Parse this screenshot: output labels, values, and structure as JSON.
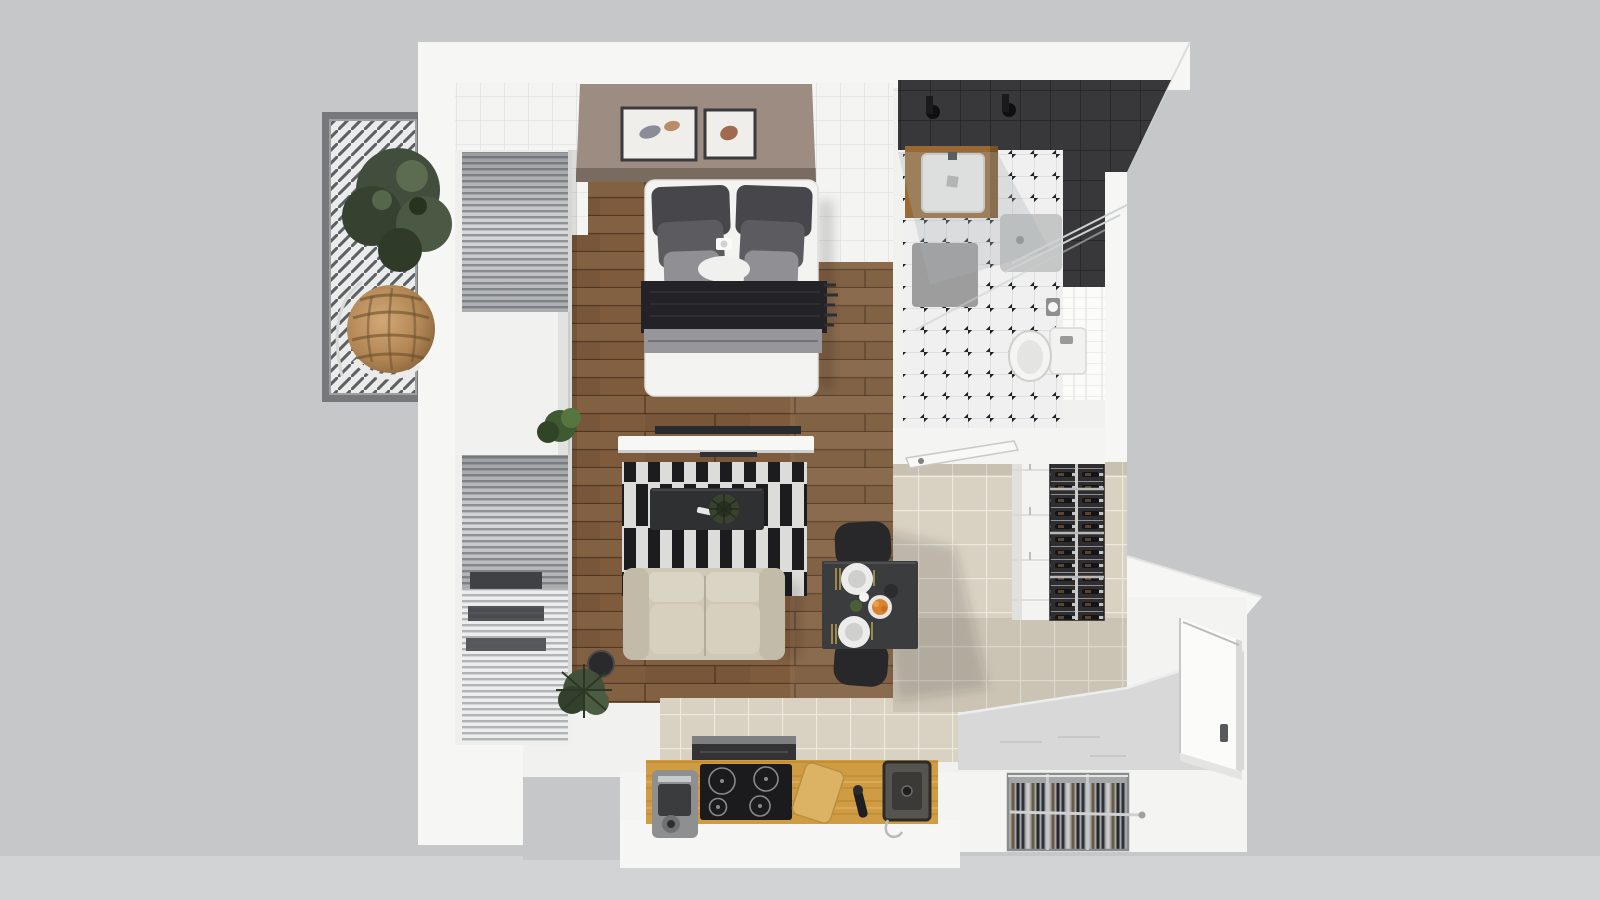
{
  "scene": {
    "kind": "3D rendered apartment floor plan, top-down view",
    "style": "photoreal studio apartment render on gray background"
  },
  "palette": {
    "background": "#c6c7c9",
    "background_lower": "#d2d3d4",
    "wall": "#f6f6f4",
    "interior_base": "#f1f1ef",
    "wood_floor": "#7e5b3c",
    "kitchen_tile": "#d9d1c1",
    "bath_floor": "#eff0ef",
    "dark_tile": "#38383a",
    "taupe_wall": "#9c8c82",
    "rug_black": "#1c1c1e",
    "rug_white": "#dcdcda",
    "sofa": "#cfc8b7",
    "oak_counter": "#cf9c44",
    "platform": "#d7d8d7",
    "entry_door": "#fbfbfa",
    "blanket": "#232327",
    "dining_table": "#3a3c3e",
    "wine_rack_bg": "#2e2e30",
    "balcony_slat": "#5c6062"
  },
  "rooms": {
    "balcony": {
      "name": "Balcony",
      "objects": [
        "louvered pergola roof",
        "tree",
        "hanging rattan chair"
      ]
    },
    "bedroom_living": {
      "name": "Bedroom / Living room",
      "objects": [
        "double bed",
        "gray pillows",
        "dark throw blanket",
        "two picture frames",
        "window blinds",
        "TV and console",
        "black-white striped rug",
        "coffee table",
        "beige loveseat sofa",
        "potted plants"
      ]
    },
    "bathroom": {
      "name": "Bathroom",
      "objects": [
        "dark tiled shower",
        "glass partition",
        "wooden vanity with sink",
        "shower tray",
        "bath mat",
        "toilet",
        "toilet paper holder",
        "diamond dot tile floor",
        "open door"
      ]
    },
    "kitchen_dining": {
      "name": "Kitchen / Dining",
      "objects": [
        "dining table",
        "two black chairs",
        "plates and bowl",
        "wine rack",
        "tall white cabinet",
        "oak counter",
        "induction cooktop",
        "range hood",
        "coffee machine",
        "cutting board",
        "black faucet",
        "undermount sink"
      ]
    },
    "entry": {
      "name": "Entry",
      "objects": [
        "white entry door",
        "gray floor platform",
        "wardrobe rack with clothes"
      ]
    }
  }
}
